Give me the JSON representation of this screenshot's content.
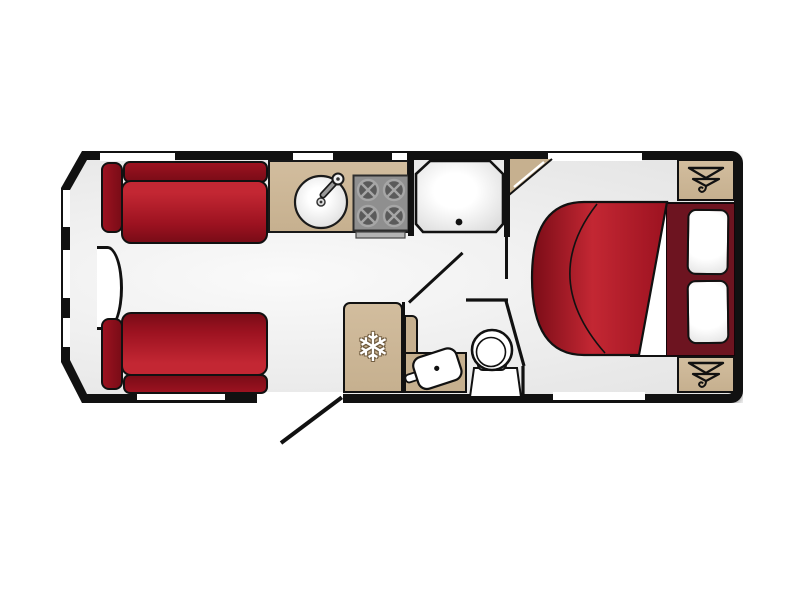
{
  "meta": {
    "type": "caravan-floorplan",
    "orientation": "side-view-top-down"
  },
  "colors": {
    "wall": "#111111",
    "floor_light": "#fafafa",
    "floor_mid": "#e9e9e9",
    "tan": "#c6b08f",
    "tan_light": "#d2bd9e",
    "red_bright": "#c32733",
    "red_mid": "#9c1220",
    "red_dark": "#7a0c17",
    "maroon": "#6d1420",
    "hob_gray": "#8f8f8f",
    "burner_gray": "#5a5a5a",
    "burner_ring": "#a6a6a6"
  },
  "icons": {
    "fridge": "snowflake-icon",
    "wardrobe": "clothes-hanger-icon"
  },
  "glyphs": {
    "snowflake": "❄"
  },
  "labels": {
    "plan": "Caravan floor plan",
    "lounge_sofa_top": "Front lounge sofa (top)",
    "lounge_sofa_bottom": "Front lounge sofa (bottom)",
    "front_chest": "Front chest",
    "kitchen_counter": "Kitchen worktop",
    "sink": "Kitchen sink",
    "hob": "Four-burner hob",
    "shower": "Shower cubicle",
    "corner_cupboard": "Corner cupboard",
    "fridge": "Fridge",
    "washbasin": "Washroom basin",
    "toilet": "Toilet",
    "bed": "Island bed",
    "pillow": "Pillow",
    "wardrobe": "Wardrobe",
    "entry_door": "Entry door (open)",
    "washroom_door": "Washroom door (open)",
    "window": "Window",
    "door_opening": "Doorway"
  }
}
